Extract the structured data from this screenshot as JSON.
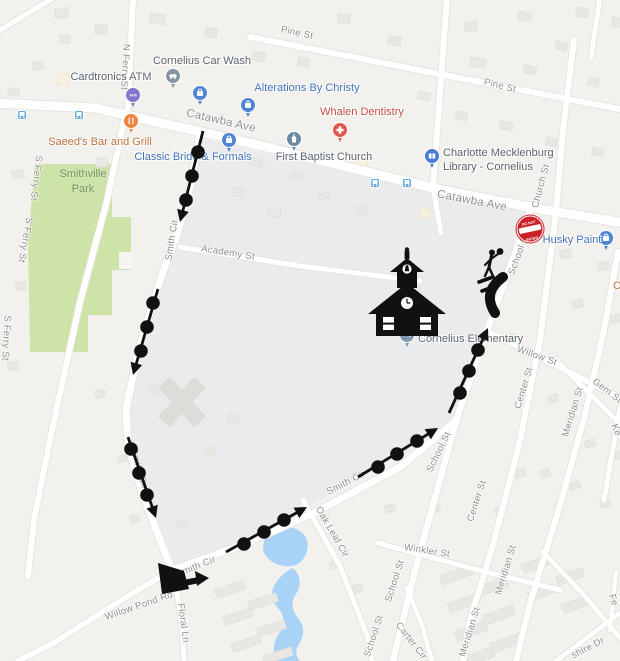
{
  "map": {
    "background": "#f2f1ee",
    "colors": {
      "road": "#ffffff",
      "park": "#cde3a8",
      "water": "#a8d3f7",
      "campus": "#eaebec",
      "building": "#e9e7e3",
      "route": "#111111",
      "poi_gray": "#5a646d",
      "poi_blue": "#4273b8",
      "poi_red": "#c14e43",
      "poi_orange": "#c1703c",
      "street_label": "#8e8e8e",
      "transit": "#62aadc"
    },
    "park": {
      "label_line1": "Smithville",
      "label_line2": "Park"
    },
    "street_labels": [
      {
        "text": "Pine St",
        "x": 297,
        "y": 33,
        "rot": 12
      },
      {
        "text": "Pine St",
        "x": 500,
        "y": 86,
        "rot": 14
      },
      {
        "text": "N Ferry St",
        "x": 125,
        "y": 67,
        "rot": 93
      },
      {
        "text": "Catawba Ave",
        "x": 221,
        "y": 121,
        "rot": 13,
        "size": 11.5
      },
      {
        "text": "Catawba Ave",
        "x": 472,
        "y": 201,
        "rot": 11,
        "size": 11.5
      },
      {
        "text": "S Ferry St",
        "x": 36,
        "y": 178,
        "rot": 97
      },
      {
        "text": "S Ferry St",
        "x": 25,
        "y": 240,
        "rot": 100
      },
      {
        "text": "S Ferry St",
        "x": 6,
        "y": 338,
        "rot": 93
      },
      {
        "text": "Smith Cir",
        "x": 172,
        "y": 240,
        "rot": -81
      },
      {
        "text": "Academy St",
        "x": 228,
        "y": 253,
        "rot": 9
      },
      {
        "text": "Church St",
        "x": 541,
        "y": 186,
        "rot": -75
      },
      {
        "text": "School St",
        "x": 519,
        "y": 254,
        "rot": -70
      },
      {
        "text": "Smith Cir",
        "x": 139,
        "y": 469,
        "rot": 74
      },
      {
        "text": "Willow St",
        "x": 537,
        "y": 356,
        "rot": 20
      },
      {
        "text": "Center St",
        "x": 524,
        "y": 388,
        "rot": -73
      },
      {
        "text": "Gem St",
        "x": 607,
        "y": 391,
        "rot": 38
      },
      {
        "text": "Meridian St",
        "x": 573,
        "y": 412,
        "rot": -73
      },
      {
        "text": "Ke",
        "x": 616,
        "y": 430,
        "rot": 70
      },
      {
        "text": "School St",
        "x": 439,
        "y": 452,
        "rot": -64
      },
      {
        "text": "Smith Cir",
        "x": 346,
        "y": 483,
        "rot": -27
      },
      {
        "text": "Center St",
        "x": 477,
        "y": 501,
        "rot": -72
      },
      {
        "text": "Oak Leaf Cir",
        "x": 332,
        "y": 532,
        "rot": 60
      },
      {
        "text": "Winkler St",
        "x": 427,
        "y": 551,
        "rot": 9
      },
      {
        "text": "Smith Cir",
        "x": 196,
        "y": 567,
        "rot": -22
      },
      {
        "text": "Meridian St",
        "x": 506,
        "y": 570,
        "rot": -73
      },
      {
        "text": "School St",
        "x": 395,
        "y": 581,
        "rot": -72
      },
      {
        "text": "Willow Pond Rd",
        "x": 139,
        "y": 606,
        "rot": -19
      },
      {
        "text": "Floral Ln",
        "x": 183,
        "y": 623,
        "rot": 82
      },
      {
        "text": "Fe",
        "x": 613,
        "y": 600,
        "rot": 72
      },
      {
        "text": "Meridian St",
        "x": 470,
        "y": 632,
        "rot": -73
      },
      {
        "text": "School St",
        "x": 374,
        "y": 636,
        "rot": -72
      },
      {
        "text": "Carter Cir",
        "x": 411,
        "y": 641,
        "rot": 52
      },
      {
        "text": "shire Dr",
        "x": 588,
        "y": 648,
        "rot": -27
      }
    ],
    "poi_labels": [
      {
        "text": "Cornelius Car Wash",
        "x": 202,
        "y": 61,
        "color": "gray"
      },
      {
        "text": "Cardtronics ATM",
        "x": 111,
        "y": 77,
        "color": "gray"
      },
      {
        "text": "Alterations By Christy",
        "x": 307,
        "y": 88,
        "color": "blue"
      },
      {
        "text": "Whalen Dentistry",
        "x": 362,
        "y": 112,
        "color": "red"
      },
      {
        "text": "Saeed's Bar and Grill",
        "x": 100,
        "y": 142,
        "color": "orange"
      },
      {
        "text": "Classic Bride & Formals",
        "x": 193,
        "y": 157,
        "color": "blue"
      },
      {
        "text": "First Baptist Church",
        "x": 324,
        "y": 157,
        "color": "gray"
      },
      {
        "text": "Charlotte Mecklenburg",
        "x": 443,
        "y": 153,
        "color": "gray",
        "align": "left"
      },
      {
        "text": "Library - Cornelius",
        "x": 443,
        "y": 167,
        "color": "gray",
        "align": "left"
      },
      {
        "text": "Husky Paint",
        "x": 572,
        "y": 240,
        "color": "blue"
      },
      {
        "text": "Cornelius Elementary",
        "x": 418,
        "y": 339,
        "color": "gray",
        "align": "left"
      },
      {
        "text": "C",
        "x": 617,
        "y": 286,
        "color": "orange"
      }
    ],
    "pins": [
      {
        "x": 173,
        "y": 76,
        "color": "#8595a0",
        "icon": "car"
      },
      {
        "x": 133,
        "y": 95,
        "color": "#8674ce",
        "icon": "atm"
      },
      {
        "x": 200,
        "y": 93,
        "color": "#5084d4",
        "icon": "bag"
      },
      {
        "x": 248,
        "y": 105,
        "color": "#5084d4",
        "icon": "bag"
      },
      {
        "x": 131,
        "y": 121,
        "color": "#ec8540",
        "icon": "food"
      },
      {
        "x": 229,
        "y": 140,
        "color": "#5084d4",
        "icon": "bag"
      },
      {
        "x": 340,
        "y": 130,
        "color": "#e25a4e",
        "icon": "cross"
      },
      {
        "x": 294,
        "y": 139,
        "color": "#6d8aa3",
        "icon": "church"
      },
      {
        "x": 432,
        "y": 156,
        "color": "#4b7ed2",
        "icon": "book"
      },
      {
        "x": 606,
        "y": 238,
        "color": "#5084d4",
        "icon": "bag"
      },
      {
        "x": 407,
        "y": 335,
        "color": "#7f98ac",
        "icon": "cap"
      }
    ],
    "transit_stops": [
      [
        22,
        115
      ],
      [
        79,
        115
      ],
      [
        375,
        183
      ],
      [
        407,
        183
      ]
    ],
    "atm_pin_text": "ATM"
  },
  "route": {
    "color": "#111111",
    "segments": [
      {
        "line": [
          [
            203,
            131
          ]
        ],
        "dots": [
          [
            198,
            152
          ],
          [
            192,
            176
          ],
          [
            186,
            200
          ]
        ],
        "arrow": [
          180,
          222
        ]
      },
      {
        "line": [
          [
            158,
            289
          ]
        ],
        "dots": [
          [
            153,
            303
          ],
          [
            147,
            327
          ],
          [
            141,
            351
          ]
        ],
        "arrow": [
          133,
          375
        ]
      },
      {
        "line": [
          [
            128,
            437
          ]
        ],
        "dots": [
          [
            131,
            449
          ],
          [
            139,
            473
          ],
          [
            147,
            495
          ]
        ],
        "arrow": [
          156,
          518
        ]
      },
      {
        "line": [
          [
            226,
            552
          ]
        ],
        "dots": [
          [
            244,
            544
          ],
          [
            264,
            532
          ],
          [
            284,
            520
          ]
        ],
        "arrow": [
          307,
          507
        ]
      },
      {
        "line": [
          [
            358,
            477
          ]
        ],
        "dots": [
          [
            378,
            467
          ],
          [
            397,
            454
          ],
          [
            417,
            441
          ]
        ],
        "arrow": [
          438,
          428
        ]
      },
      {
        "line": [
          [
            449,
            413
          ]
        ],
        "dots": [
          [
            460,
            393
          ],
          [
            469,
            371
          ],
          [
            478,
            350
          ]
        ],
        "arrow": [
          488,
          328
        ]
      }
    ],
    "turn_path": "M503,277 C489,287 486,299 495,313",
    "crosswalk": [
      [
        [
          479,
          282
        ],
        [
          493,
          277
        ]
      ],
      [
        [
          482,
          291
        ],
        [
          496,
          286
        ]
      ]
    ]
  },
  "markers": {
    "do_not_enter": {
      "line1": "DO NOT",
      "line2": "ENTER"
    }
  }
}
